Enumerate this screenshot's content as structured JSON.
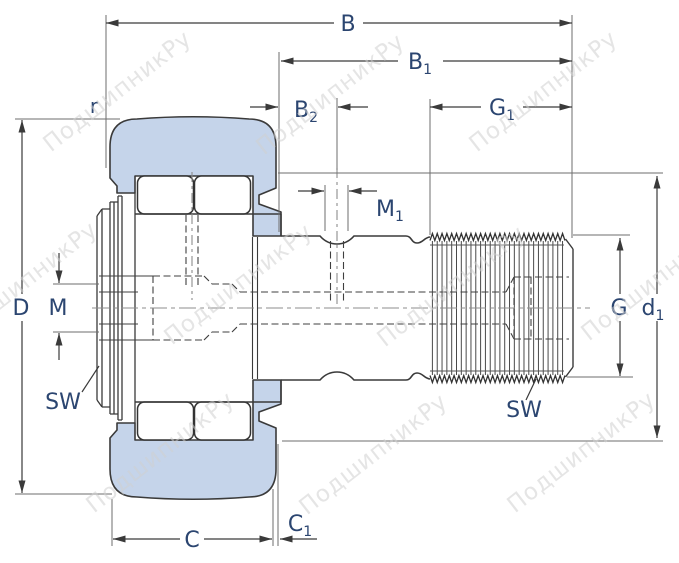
{
  "drawing": {
    "type": "bearing-cross-section",
    "description_labels": {
      "B": {
        "base": "B"
      },
      "B1": {
        "base": "B",
        "sub": "1"
      },
      "B2": {
        "base": "B",
        "sub": "2"
      },
      "G1": {
        "base": "G",
        "sub": "1"
      },
      "M1": {
        "base": "M",
        "sub": "1"
      },
      "r": {
        "base": "r"
      },
      "D": {
        "base": "D"
      },
      "M": {
        "base": "M"
      },
      "SW_left": {
        "base": "SW"
      },
      "SW_right": {
        "base": "SW"
      },
      "G": {
        "base": "G"
      },
      "d1": {
        "base": "d",
        "sub": "1"
      },
      "C": {
        "base": "C"
      },
      "C1": {
        "base": "C",
        "sub": "1"
      }
    }
  },
  "watermark": {
    "text": "ПодшипникРу"
  },
  "colors": {
    "ring_fill": "#c5d4ea",
    "outline": "#3a3a3a",
    "thin_line": "#4a4a4a",
    "ext_line": "#6e6e6e",
    "center_line": "#8c8c8c",
    "label_color": "#2b4570",
    "watermark_color": "#cfcfcf"
  }
}
